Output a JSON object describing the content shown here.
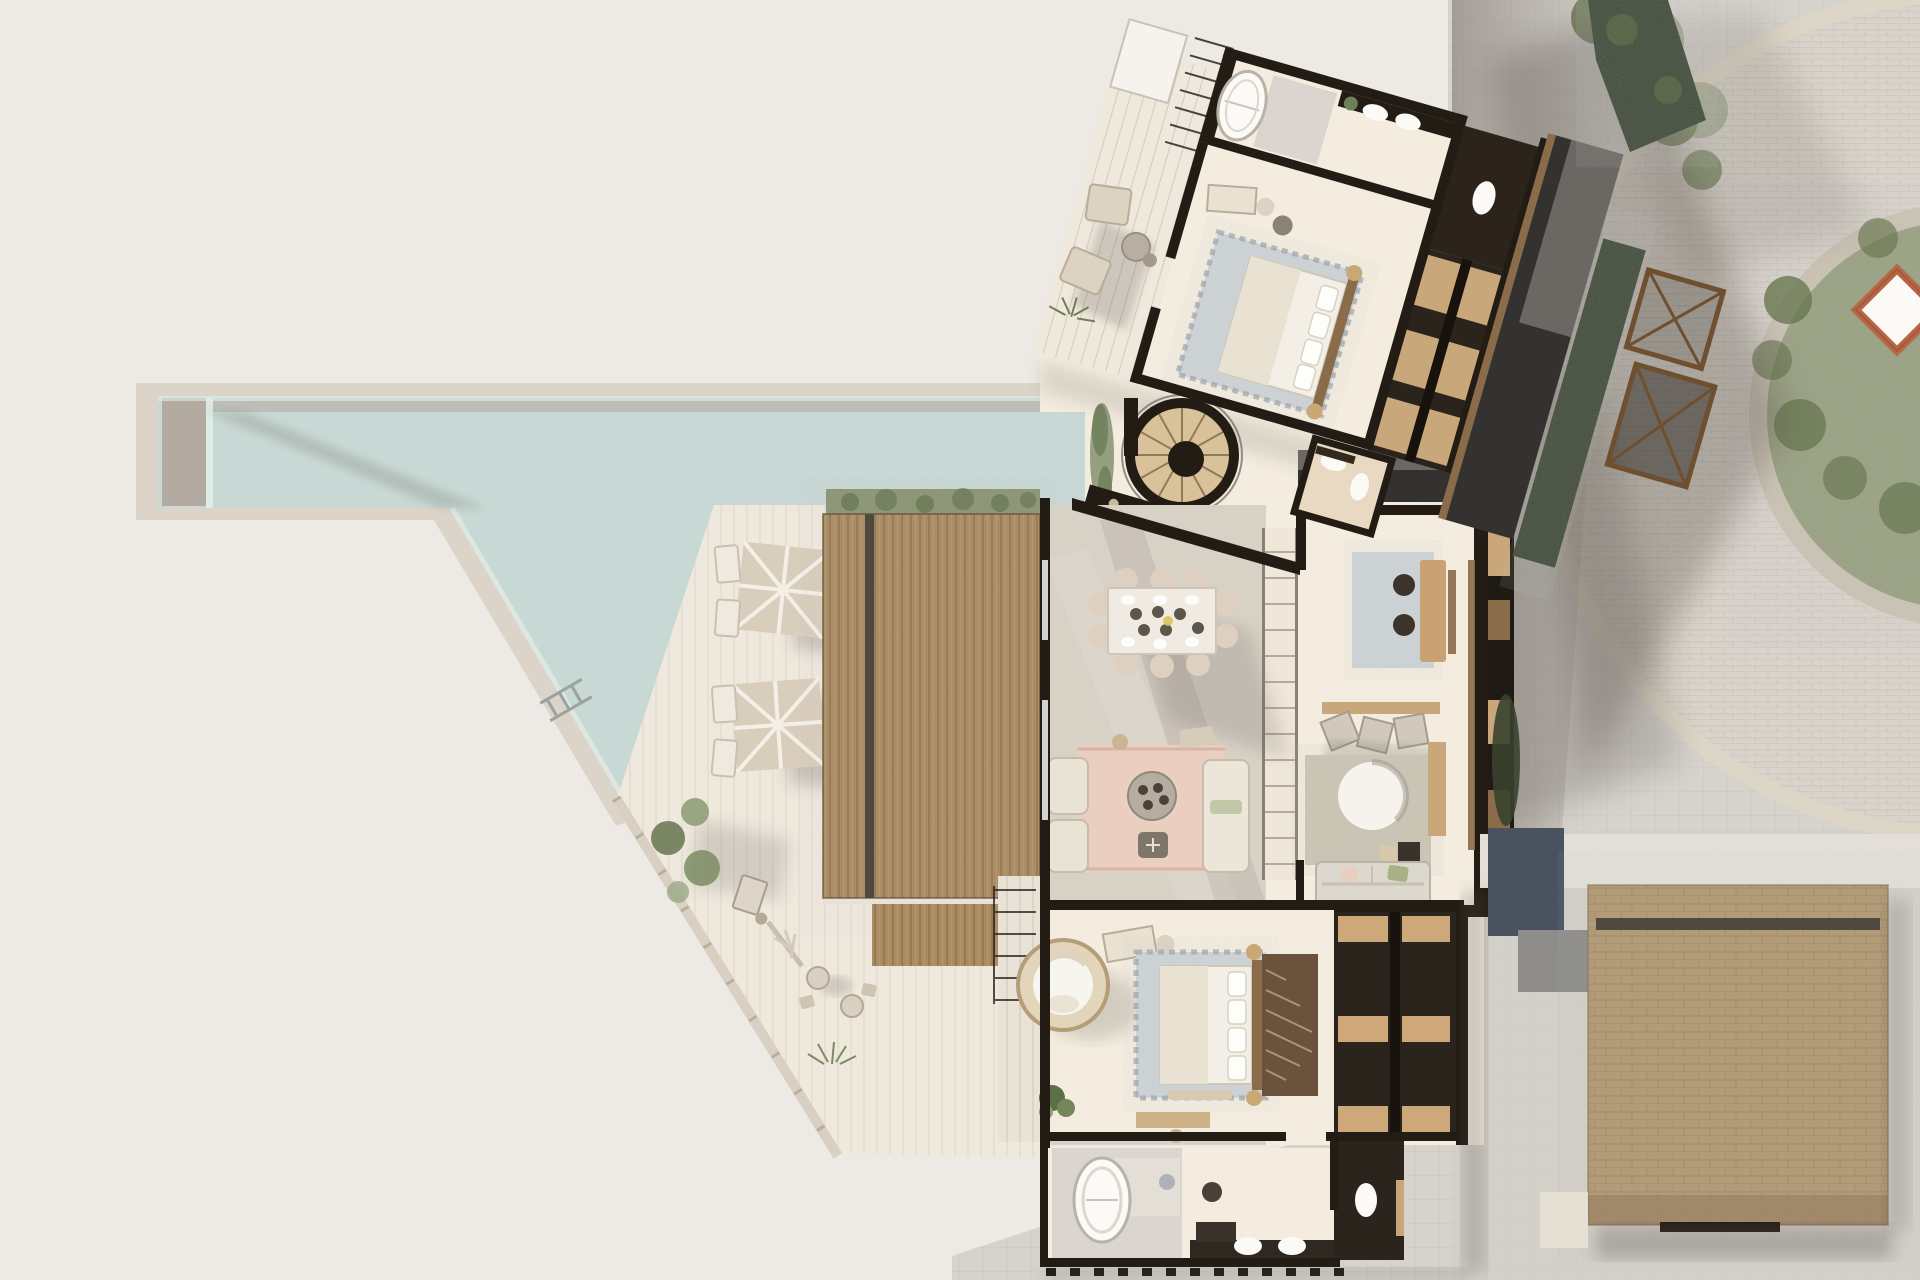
{
  "canvas": {
    "width": 1920,
    "height": 1280
  },
  "scene": {
    "type": "architectural-site-plan",
    "visible_text": [],
    "features": {
      "pool": "L-shaped infinity pool with tanning shelf, ladder and angled edge",
      "umbrella_count": 2,
      "sun_lounger_count": 4,
      "bedroom_suites": 2,
      "spiral_stair": "circular stair with radial timber treads",
      "roofs": [
        "timber slat pergola roof",
        "brick roof with skylight slot",
        "charcoal flat roof",
        "navy flat roof"
      ],
      "landscape": [
        "curved paver road",
        "circular garden with terracotta pavilion",
        "hedge bands",
        "trees"
      ]
    }
  },
  "palette": {
    "bg": "#EDEAE6",
    "paving": "#D6D2CC",
    "paving_line": "#C5C0B8",
    "road": "#D8D3CB",
    "curb": "#DDD5C6",
    "stone_ring": "#CBC3B4",
    "garden": "#9AA284",
    "foliage": "#66754F",
    "shrub": "#8B9575",
    "hedge": "#3E4937",
    "water": "#C8D8D4",
    "water_light": "#E2EEEA",
    "pool_stone": "#DCD4C9",
    "pool_taupe": "#B3AAA1",
    "deck": "#EFE8DD",
    "floor": "#F3ECDF",
    "floor_gray": "#D8D1C6",
    "court": "#EFE9DC",
    "wall": "#221C14",
    "wood": "#8A6C4A",
    "tan": "#C9A77B",
    "roof_slat": "#A98A61",
    "roof_slat_dark": "#8F7250",
    "roof_brick": "#B29974",
    "brick_dark": "#9A8263",
    "groove": "#4E4A42",
    "navy_roof": "#4A5260",
    "charcoal": "#343230",
    "gray_roof": "#75726C",
    "cream": "#EAE4D6",
    "white": "#FBFAF6",
    "gray_tile": "#DAD5CE",
    "rug_blue": "#CDD3D6",
    "rug_pink": "#EACFC0",
    "rug_beige": "#CCC5B4",
    "shadow": "#5A534B",
    "umbrella": "#D9CDBC",
    "terracotta": "#B86746"
  }
}
